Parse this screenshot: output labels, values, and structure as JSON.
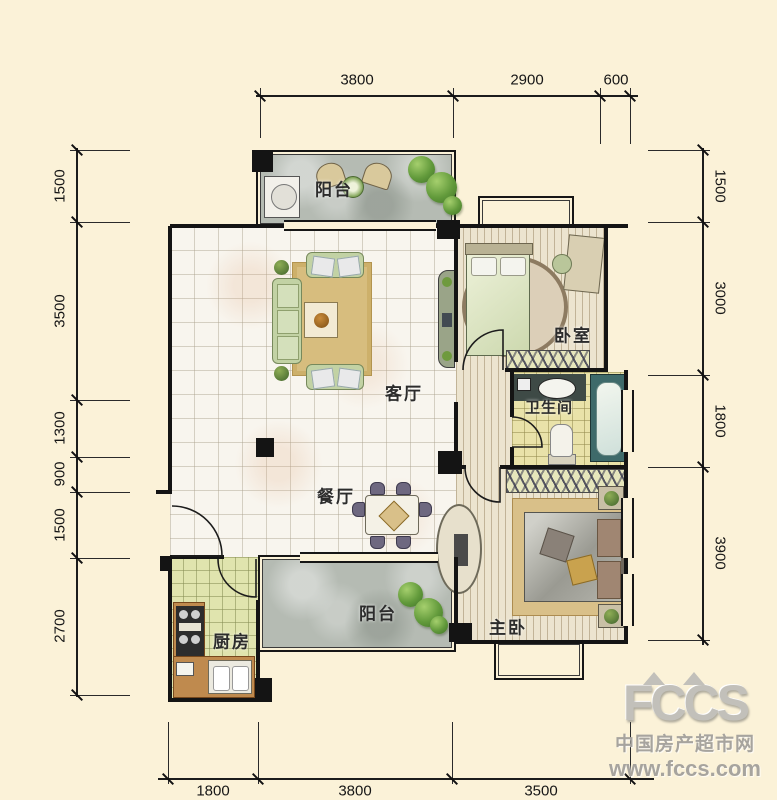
{
  "rooms": {
    "balcony_top": "阳台",
    "living": "客厅",
    "bedroom": "卧室",
    "bathroom": "卫生间",
    "dining": "餐厅",
    "balcony_bottom": "阳台",
    "kitchen": "厨房",
    "master": "主卧"
  },
  "dimensions": {
    "top": [
      "3800",
      "2900",
      "600"
    ],
    "bottom": [
      "1800",
      "3800",
      "3500"
    ],
    "left": [
      "1500",
      "3500",
      "1300",
      "900",
      "1500",
      "2700"
    ],
    "right": [
      "1500",
      "3000",
      "1800",
      "3900"
    ]
  },
  "watermark": {
    "logo": "FCCS",
    "name": "中国房产超市网",
    "url": "www.fccs.com"
  },
  "colors": {
    "background": "#fbf2d8",
    "wall": "#141414",
    "balcony_floor": "#b5bbb3",
    "kitchen_floor": "#e0e4ae",
    "bathroom_floor": "#e9e2a9",
    "wood_floor": "#ece4cf",
    "rug_gold": "#d7bd7e",
    "sofa_green": "#c2d2a4",
    "tub_teal": "#3e6a6a",
    "plant_green": "#629a3b",
    "watermark_gray": "#a7a49e"
  }
}
